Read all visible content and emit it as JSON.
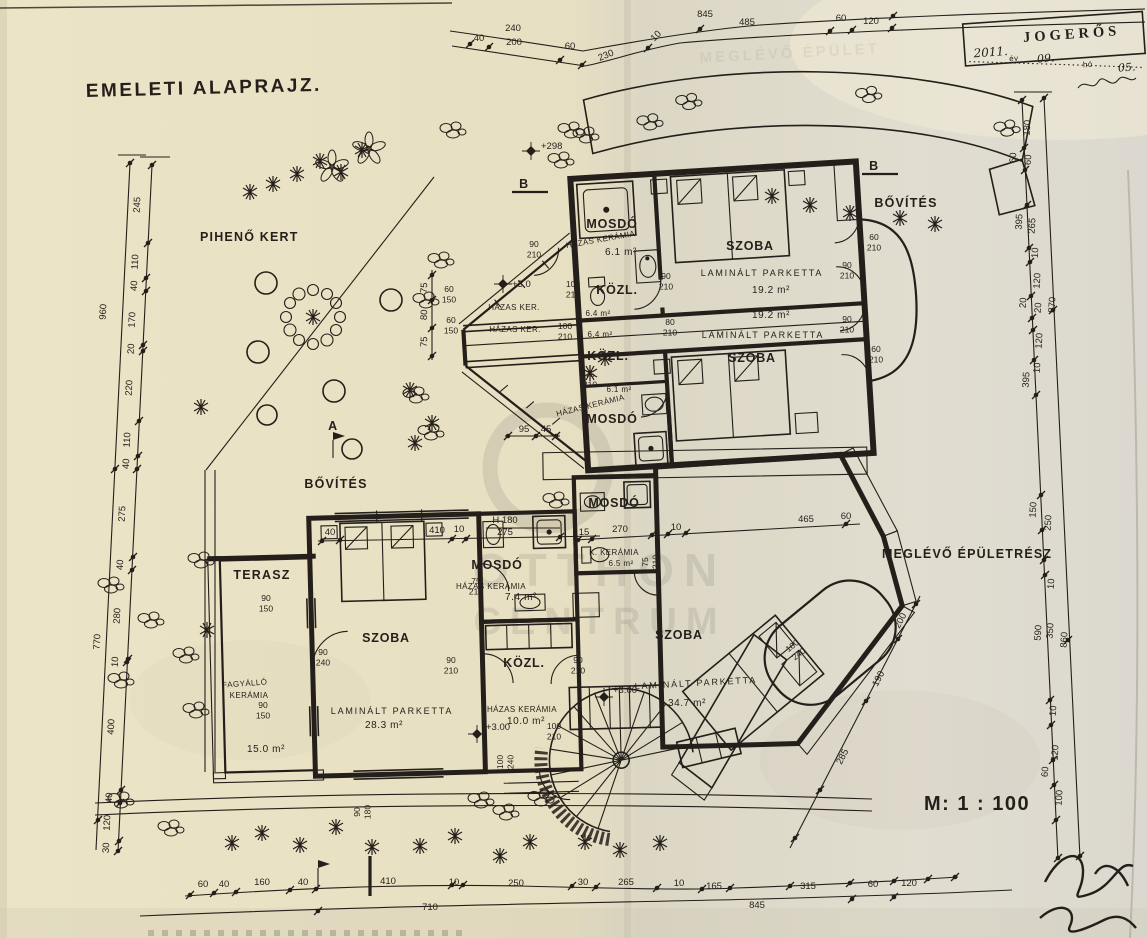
{
  "title": "EMELETI ALAPRAJZ.",
  "scale": "M: 1 : 100",
  "stamp": {
    "word": "JOGERŐS",
    "year": "2011.",
    "ev": "év",
    "month": "09.",
    "ho": "hó",
    "day": "05."
  },
  "watermark": {
    "line1": "OTTHON",
    "line2": "CENTRUM",
    "ghost": "MEGLÉVŐ ÉPÜLET"
  },
  "site": {
    "garden": "PIHENŐ KERT",
    "bovites_left": "BŐVÍTÉS",
    "bovites_right": "BŐVÍTÉS",
    "existing": "MEGLÉVŐ ÉPÜLETRÉSZ",
    "sa": "A",
    "sb1": "B",
    "sb2": "B"
  },
  "rooms": {
    "mosdo1": {
      "name": "MOSDÓ",
      "finish": "HÁZAS KERÁMIA",
      "area": "6.1 m²"
    },
    "szoba1": {
      "name": "SZOBA",
      "finish": "LAMINÁLT PARKETTA",
      "area": "19.2 m²"
    },
    "kozl1": {
      "name": "KÖZL.",
      "finish": "HÁZAS KER.",
      "area": "6.4 m²"
    },
    "kozl2": {
      "name": "KÖZL.",
      "finish": "HÁZAS KER.",
      "area": "6.4 m²"
    },
    "szoba2": {
      "name": "SZOBA",
      "finish": "LAMINÁLT PARKETTA",
      "area": "19.2 m²"
    },
    "mosdo2": {
      "name": "MOSDÓ",
      "finish": "HÁZAS KERÁMIA",
      "area": "6.1 m²"
    },
    "mosdo3": {
      "name": "MOSDÓ",
      "finish": "K. KERÁMIA",
      "area": "6.5 m²"
    },
    "mosdo4": {
      "name": "MOSDÓ",
      "finish": "HÁZAS KERÁMIA",
      "area": "7.4 m²"
    },
    "szoba3": {
      "name": "SZOBA",
      "finish": "LAMINÁLT PARKETTA",
      "area": "34.7 m²"
    },
    "kozl3": {
      "name": "KÖZL.",
      "finish": "HÁZAS KERÁMIA",
      "area": "10.0 m²"
    },
    "szoba4": {
      "name": "SZOBA",
      "finish": "LAMINÁLT PARKETTA",
      "area": "28.3 m²"
    },
    "terasz": {
      "name": "TERASZ",
      "finish1": "FAGYÁLLÓ",
      "finish2": "KERÁMIA",
      "area": "15.0 m²"
    }
  },
  "levels": {
    "szoba3": "+3.00",
    "kozl3": "+3.00",
    "garden": "+3.0",
    "garden_top": "+298"
  },
  "dims": {
    "top": [
      "40",
      "240",
      "200",
      "60",
      "230",
      "10",
      "845",
      "485",
      "60",
      "120"
    ],
    "left": [
      "245",
      "110",
      "40",
      "170",
      "20",
      "220",
      "110",
      "40",
      "275",
      "40",
      "280",
      "10",
      "400",
      "40",
      "120",
      "30"
    ],
    "left_totals": [
      "960",
      "770"
    ],
    "bottom": [
      "60",
      "40",
      "160",
      "40",
      "410",
      "10",
      "250",
      "30",
      "265",
      "10",
      "165",
      "315",
      "60",
      "120"
    ],
    "bottom_totals": [
      "710",
      "845"
    ],
    "right": [
      "180",
      "60",
      "60",
      "395",
      "265",
      "10",
      "120",
      "20",
      "20",
      "870",
      "120",
      "10",
      "395",
      "150",
      "250",
      "10",
      "590",
      "350",
      "860",
      "10",
      "60",
      "120",
      "100"
    ],
    "diag": [
      "200",
      "190",
      "285"
    ],
    "szoba4_line": [
      "40",
      "410",
      "10",
      "275"
    ],
    "h180": "H 180",
    "szoba3_line": [
      "15",
      "270",
      "10",
      "465",
      "60"
    ],
    "bay_bottom": [
      "95",
      "45"
    ],
    "bay_side": [
      "75",
      "80",
      "75"
    ]
  },
  "openings": [
    {
      "w": "60",
      "h": "210"
    },
    {
      "w": "90",
      "h": "210"
    },
    {
      "w": "90",
      "h": "210"
    },
    {
      "w": "60",
      "h": "210"
    },
    {
      "w": "90",
      "h": "210"
    },
    {
      "w": "80",
      "h": "210"
    },
    {
      "w": "100",
      "h": "210"
    },
    {
      "w": "100",
      "h": "210"
    },
    {
      "w": "75",
      "h": "210"
    },
    {
      "w": "90",
      "h": "210"
    },
    {
      "w": "60",
      "h": "150"
    },
    {
      "w": "60",
      "h": "150"
    },
    {
      "w": "75",
      "h": "210"
    },
    {
      "w": "75",
      "h": "210"
    },
    {
      "w": "90",
      "h": "210"
    },
    {
      "w": "90",
      "h": "210"
    },
    {
      "w": "100",
      "h": "210"
    },
    {
      "w": "100",
      "h": "240"
    },
    {
      "w": "100",
      "h": "240"
    },
    {
      "w": "90",
      "h": "240"
    },
    {
      "w": "90",
      "h": "150"
    },
    {
      "w": "90",
      "h": "150"
    },
    {
      "w": "90",
      "h": "180"
    }
  ]
}
